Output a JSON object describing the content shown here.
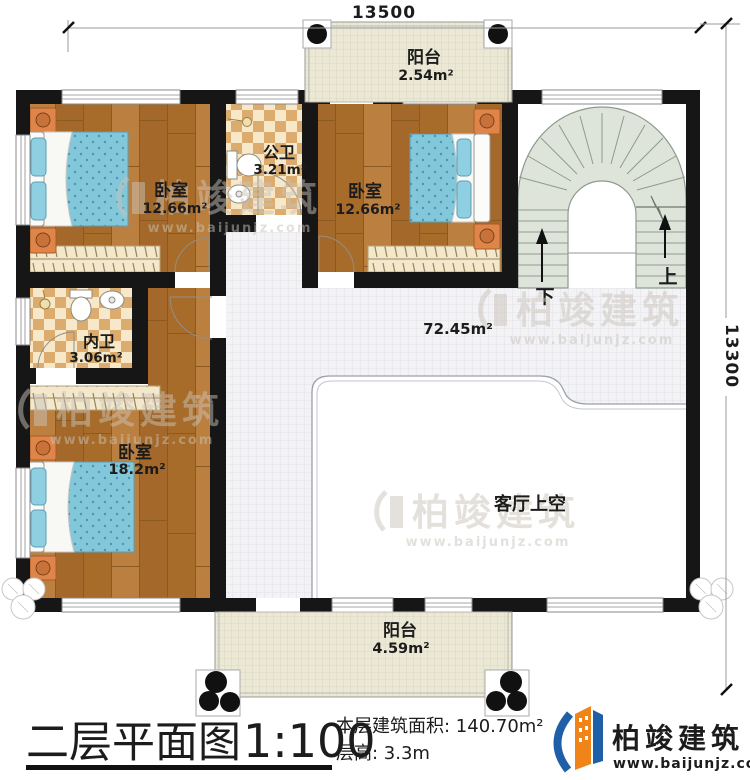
{
  "dimensions": {
    "width": "13500",
    "height": "13300"
  },
  "rooms": {
    "balcony_top": {
      "name": "阳台",
      "area": "2.54m²"
    },
    "bath_public": {
      "name": "公卫",
      "area": "3.21m²"
    },
    "bedroom_left": {
      "name": "卧室",
      "area": "12.66m²"
    },
    "bedroom_right": {
      "name": "卧室",
      "area": "12.66m²"
    },
    "bath_ensuite": {
      "name": "内卫",
      "area": "3.06m²"
    },
    "bedroom_bottom": {
      "name": "卧室",
      "area": "18.2m²"
    },
    "hall": {
      "area": "72.45m²"
    },
    "void": {
      "name": "客厅上空"
    },
    "balcony_bottom": {
      "name": "阳台",
      "area": "4.59m²"
    }
  },
  "stairs": {
    "up": "上",
    "down": "下"
  },
  "titleblock": {
    "title": "二层平面图",
    "scale": "1:100",
    "area_line": "本层建筑面积: 140.70m²",
    "height_line": "层高: 3.3m"
  },
  "brand": {
    "name": "柏竣建筑",
    "url": "www.baijunjz.com"
  },
  "watermark": {
    "name": "柏竣建筑",
    "url": "www.baijunjz.com"
  },
  "colors": {
    "wall": "#161616",
    "wood": "#b0742f",
    "stair_fill": "#dee4d9",
    "brand_orange": "#e87722",
    "brand_blue": "#1e5fa8"
  }
}
